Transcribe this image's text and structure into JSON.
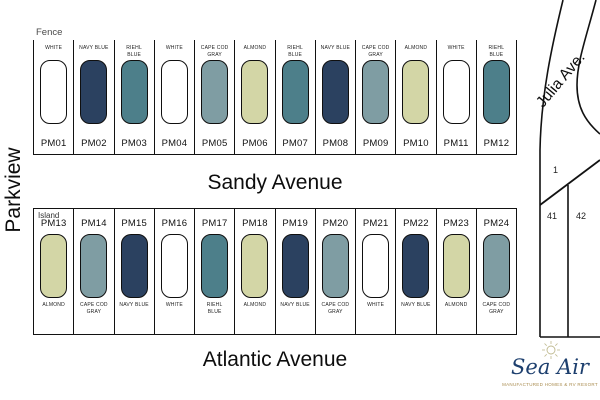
{
  "palette": {
    "WHITE": "#ffffff",
    "NAVY BLUE": "#2b4160",
    "RIEHL BLUE": "#4d7f8a",
    "CAPE COD GRAY": "#7f9da3",
    "ALMOND": "#d3d6a6"
  },
  "labels": {
    "parkview": "Parkview",
    "fence": "Fence",
    "island": "Island",
    "julia_ave": "Julia Ave.",
    "lot_1": "1",
    "lot_41": "41",
    "lot_42": "42"
  },
  "rows": {
    "sandy": {
      "street": "Sandy Avenue",
      "area_label": "Fence",
      "lots": [
        {
          "id": "PM01",
          "color": "WHITE"
        },
        {
          "id": "PM02",
          "color": "NAVY BLUE"
        },
        {
          "id": "PM03",
          "color": "RIEHL BLUE"
        },
        {
          "id": "PM04",
          "color": "WHITE"
        },
        {
          "id": "PM05",
          "color": "CAPE COD GRAY"
        },
        {
          "id": "PM06",
          "color": "ALMOND"
        },
        {
          "id": "PM07",
          "color": "RIEHL BLUE"
        },
        {
          "id": "PM08",
          "color": "NAVY BLUE"
        },
        {
          "id": "PM09",
          "color": "CAPE COD GRAY"
        },
        {
          "id": "PM10",
          "color": "ALMOND"
        },
        {
          "id": "PM11",
          "color": "WHITE"
        },
        {
          "id": "PM12",
          "color": "RIEHL BLUE"
        }
      ]
    },
    "atlantic": {
      "street": "Atlantic Avenue",
      "area_label": "Island",
      "lots": [
        {
          "id": "PM13",
          "color": "ALMOND"
        },
        {
          "id": "PM14",
          "color": "CAPE COD GRAY"
        },
        {
          "id": "PM15",
          "color": "NAVY BLUE"
        },
        {
          "id": "PM16",
          "color": "WHITE"
        },
        {
          "id": "PM17",
          "color": "RIEHL BLUE"
        },
        {
          "id": "PM18",
          "color": "ALMOND"
        },
        {
          "id": "PM19",
          "color": "NAVY BLUE"
        },
        {
          "id": "PM20",
          "color": "CAPE COD GRAY"
        },
        {
          "id": "PM21",
          "color": "WHITE"
        },
        {
          "id": "PM22",
          "color": "NAVY BLUE"
        },
        {
          "id": "PM23",
          "color": "ALMOND"
        },
        {
          "id": "PM24",
          "color": "CAPE COD GRAY"
        }
      ]
    }
  },
  "logo": {
    "name": "Sea Air",
    "tagline": "MANUFACTURED HOMES & RV RESORT",
    "text_color": "#1d3f6e",
    "tagline_color": "#a98c4f",
    "sun_color": "#bfb98f"
  }
}
